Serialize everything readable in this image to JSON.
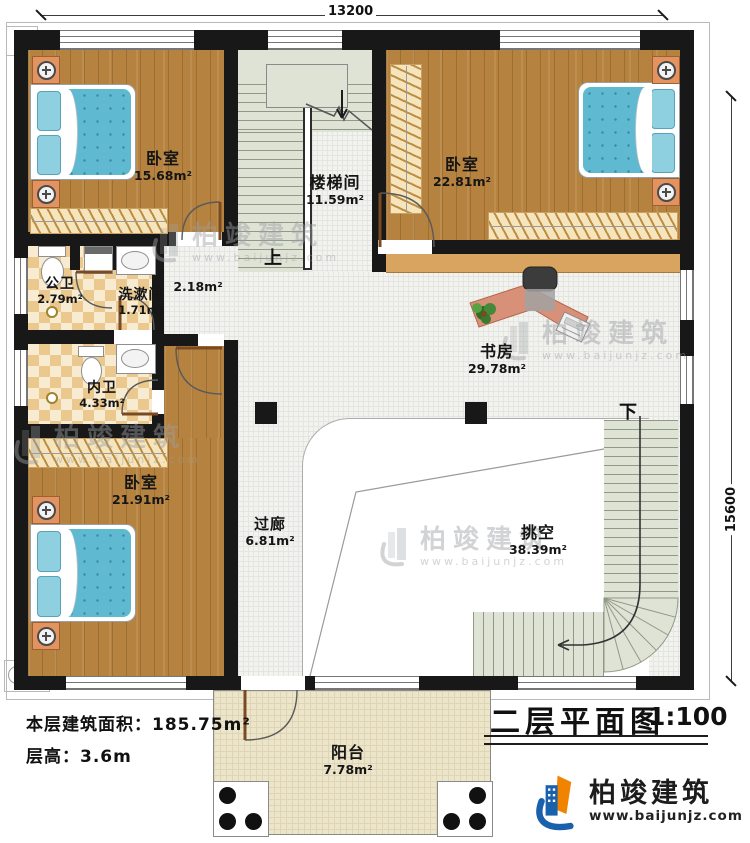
{
  "dims": {
    "width": "13200",
    "height": "15600"
  },
  "rooms": {
    "bedroom_tl": {
      "name": "卧室",
      "area": "15.68m²"
    },
    "stairwell": {
      "name": "楼梯间",
      "area": "11.59m²"
    },
    "bedroom_tr": {
      "name": "卧室",
      "area": "22.81m²"
    },
    "public_bath": {
      "name": "公卫",
      "area": "2.79m²"
    },
    "washroom": {
      "name": "洗漱间",
      "area": "1.71m²"
    },
    "hall": {
      "area": "2.18m²"
    },
    "inner_bath": {
      "name": "内卫",
      "area": "4.33m²"
    },
    "study": {
      "name": "书房",
      "area": "29.78m²"
    },
    "bedroom_bl": {
      "name": "卧室",
      "area": "21.91m²"
    },
    "corridor": {
      "name": "过廊",
      "area": "6.81m²"
    },
    "void": {
      "name": "挑空",
      "area": "38.39m²"
    },
    "balcony": {
      "name": "阳台",
      "area": "7.78m²"
    }
  },
  "stairs": {
    "up": "上",
    "down": "下"
  },
  "info": {
    "area_label": "本层建筑面积：",
    "area_value": "185.75m²",
    "height_label": "层高：",
    "height_value": "3.6m"
  },
  "titleblock": {
    "name": "二层平面图",
    "scale": "1:100"
  },
  "brand": {
    "name": "柏竣建筑",
    "url": "www.baijunjz.com"
  },
  "colors": {
    "wall": "#181818",
    "wood_floor": "#b5823f",
    "stair_floor": "#dee3d6",
    "tile_checker": "#eac88e",
    "balcony_floor": "#ece5c9",
    "brand_blue": "#1961ac",
    "brand_orange": "#f08300"
  }
}
